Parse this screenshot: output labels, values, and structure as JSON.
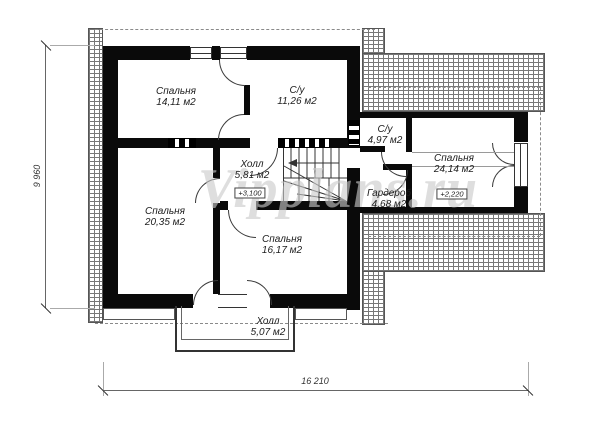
{
  "watermark": "Vipplans.ru",
  "rooms": [
    {
      "id": "bedroom-1",
      "name": "Спальня",
      "area": "14,11 м2"
    },
    {
      "id": "bathroom-1",
      "name": "С/у",
      "area": "11,26 м2"
    },
    {
      "id": "hall-upper",
      "name": "Холл",
      "area": "5,81 м2",
      "elevation": "+3,100"
    },
    {
      "id": "bathroom-2",
      "name": "С/у",
      "area": "4,97 м2"
    },
    {
      "id": "bedroom-right",
      "name": "Спальня",
      "area": "24,14 м2",
      "elevation": "+2,220"
    },
    {
      "id": "wardrobe",
      "name": "Гардероб",
      "area": "4,68 м2"
    },
    {
      "id": "bedroom-2",
      "name": "Спальня",
      "area": "20,35 м2"
    },
    {
      "id": "bedroom-3",
      "name": "Спальня",
      "area": "16,17 м2"
    },
    {
      "id": "hall-balcony",
      "name": "Холл",
      "area": "5,07 м2"
    }
  ],
  "dimensions": {
    "width": "16 210",
    "height": "9 960"
  }
}
